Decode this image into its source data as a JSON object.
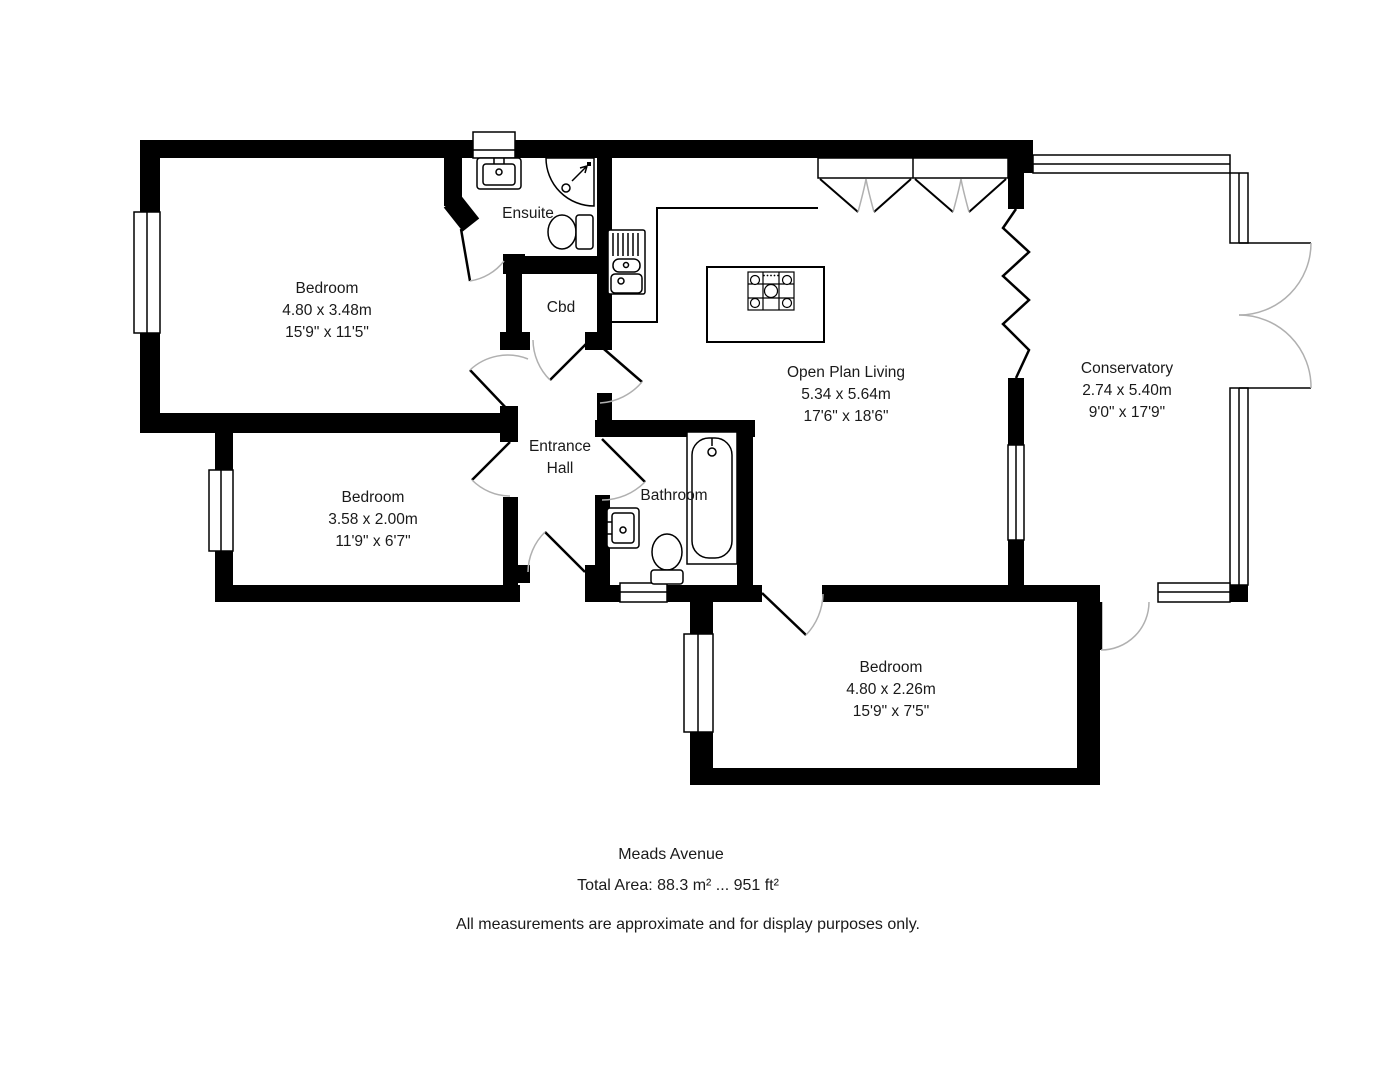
{
  "footer": {
    "address": "Meads Avenue",
    "total_area": "Total Area: 88.3 m² ... 951 ft²",
    "disclaimer": "All measurements are approximate and for display purposes only."
  },
  "rooms": {
    "bedroom1": {
      "name": "Bedroom",
      "metric": "4.80 x 3.48m",
      "imperial": "15'9\" x 11'5\""
    },
    "bedroom2": {
      "name": "Bedroom",
      "metric": "3.58 x 2.00m",
      "imperial": "11'9\" x 6'7\""
    },
    "bedroom3": {
      "name": "Bedroom",
      "metric": "4.80 x 2.26m",
      "imperial": "15'9\" x 7'5\""
    },
    "open_plan_living": {
      "name": "Open Plan Living",
      "metric": "5.34 x 5.64m",
      "imperial": "17'6\" x 18'6\""
    },
    "conservatory": {
      "name": "Conservatory",
      "metric": "2.74 x 5.40m",
      "imperial": "9'0\" x 17'9\""
    },
    "ensuite": {
      "name": "Ensuite"
    },
    "bathroom": {
      "name": "Bathroom"
    },
    "entrance_hall": {
      "name": "Entrance Hall"
    },
    "cupboard": {
      "name": "Cbd"
    }
  },
  "fixtures": [
    "kitchen-counter",
    "kitchen-sink",
    "kitchen-island",
    "hob",
    "shower",
    "ensuite-sink",
    "ensuite-toilet",
    "bath",
    "bathroom-sink",
    "toilet"
  ],
  "colors": {
    "walls": "#000000",
    "door_arc": "#b0b0b0",
    "background": "#ffffff"
  }
}
